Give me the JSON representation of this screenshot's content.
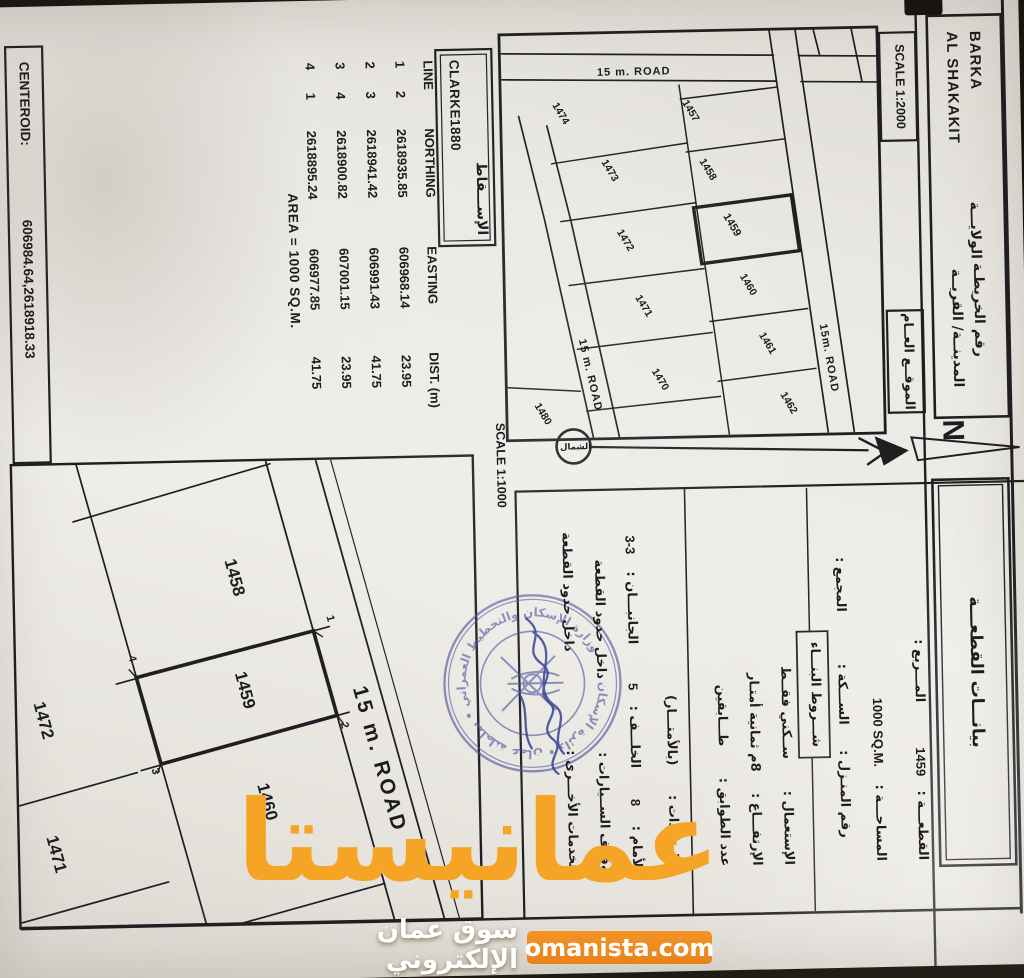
{
  "colors": {
    "ink": "#1d1d20",
    "paper": "#eae8e3",
    "stamp_blue": "#4a4f9b",
    "watermark_orange": "#f6a426",
    "pill_orange": "#ee8c1e"
  },
  "header": {
    "wilaya_label": "الولايـــة",
    "wilaya_value": "BARKA",
    "map_number_label": "رقم الخريطـة",
    "city_label": "المدينــة/ القريــة",
    "city_value": "AL SHAKAKIT",
    "location_map_label": "الموقــع العــام",
    "scale_location": "SCALE 1:2000",
    "plot_data_title": "بيانـــات القطعـــة"
  },
  "north": {
    "letter": "N",
    "circle_label": "الشمال"
  },
  "plot_details": {
    "conditions_box_label": "شـــروط البنـــاء",
    "rows": [
      {
        "y": 106,
        "items": [
          {
            "t": "القطعـــة :",
            "x": 872
          },
          {
            "t": "1459",
            "x": 788,
            "latin": true
          },
          {
            "t": "المـــربع :",
            "x": 714
          }
        ]
      },
      {
        "y": 148,
        "items": [
          {
            "t": "المساحـــة :",
            "x": 872
          },
          {
            "t": "1000 SQ.M.",
            "x": 778,
            "latin": true
          }
        ]
      },
      {
        "y": 183,
        "items": [
          {
            "t": "رقم المنـزل :",
            "x": 848
          },
          {
            "t": "الســـكة :",
            "x": 735
          },
          {
            "t": "المجمع :",
            "x": 622
          }
        ]
      },
      {
        "y": 240,
        "items": [
          {
            "t": "الإستعمال :",
            "x": 874
          },
          {
            "t": "ســكني فقــط",
            "x": 768
          }
        ]
      },
      {
        "y": 272,
        "items": [
          {
            "t": "الإرتفـــاع :",
            "x": 874
          },
          {
            "t": "8م ثمانية أمتـار",
            "x": 780
          }
        ]
      },
      {
        "y": 304,
        "items": [
          {
            "t": "عدد الطوابق :",
            "x": 874
          },
          {
            "t": "طـــابقين",
            "x": 754
          }
        ]
      },
      {
        "y": 355,
        "items": [
          {
            "t": "الإرتدادات :",
            "x": 874
          },
          {
            "t": "(بالأمتـــار)",
            "x": 772
          }
        ]
      },
      {
        "y": 392,
        "items": [
          {
            "t": "الأمام :",
            "x": 878
          },
          {
            "t": "8",
            "x": 812,
            "latin": true
          },
          {
            "t": "الخلـــف :",
            "x": 774
          },
          {
            "t": "5",
            "x": 696,
            "latin": true
          },
          {
            "t": "الجانبـــان :",
            "x": 650
          },
          {
            "t": "3-3",
            "x": 560,
            "latin": true
          }
        ]
      },
      {
        "y": 424,
        "items": [
          {
            "t": "وقوف الســيارات :",
            "x": 878
          },
          {
            "t": "داخل حدود القطعة",
            "x": 684
          }
        ]
      },
      {
        "y": 456,
        "items": [
          {
            "t": "الخدمات الأخـــرى :",
            "x": 878
          },
          {
            "t": "داخل حدود القطعة",
            "x": 656
          }
        ]
      }
    ]
  },
  "projection": {
    "label": "الإســـقاط",
    "value": "CLARKE1880"
  },
  "coords_table": {
    "headers": [
      "LINE",
      "NORTHING",
      "EASTING",
      "DIST. (m)"
    ],
    "rows": [
      [
        "1",
        "2",
        "2618935.85",
        "606968.14",
        "23.95"
      ],
      [
        "2",
        "3",
        "2618941.42",
        "606991.43",
        "41.75"
      ],
      [
        "3",
        "4",
        "2618900.82",
        "607001.15",
        "23.95"
      ],
      [
        "4",
        "1",
        "2618895.24",
        "606977.85",
        "41.75"
      ]
    ],
    "area_line": "AREA = 1000 SQ.M."
  },
  "centeroid": {
    "label": "CENTEROID:",
    "value": "606984.64,2618918.33"
  },
  "scale_site": "SCALE 1:1000",
  "location_map": {
    "plots": [
      {
        "n": "1457",
        "x": 118,
        "y": 330
      },
      {
        "n": "1458",
        "x": 177,
        "y": 314
      },
      {
        "n": "1459",
        "x": 233,
        "y": 291,
        "bold": true
      },
      {
        "n": "1460",
        "x": 293,
        "y": 276
      },
      {
        "n": "1461",
        "x": 352,
        "y": 258
      },
      {
        "n": "1462",
        "x": 412,
        "y": 238
      },
      {
        "n": "1474",
        "x": 118,
        "y": 460
      },
      {
        "n": "1473",
        "x": 176,
        "y": 412
      },
      {
        "n": "1472",
        "x": 246,
        "y": 398
      },
      {
        "n": "1471",
        "x": 312,
        "y": 381
      },
      {
        "n": "1470",
        "x": 386,
        "y": 366
      },
      {
        "n": "1480",
        "x": 418,
        "y": 484
      }
    ],
    "road_labels": [
      {
        "t": "15 m. ROAD",
        "x": 78,
        "y": 386,
        "r": -90
      },
      {
        "t": "15m. ROAD",
        "x": 368,
        "y": 197,
        "r": -9
      },
      {
        "t": "15 m. ROAD",
        "x": 380,
        "y": 436,
        "r": -12
      }
    ]
  },
  "site_plan": {
    "road_label": {
      "t": "15 m. ROAD",
      "x": 760,
      "y": 655,
      "r": -14.5
    },
    "labels": [
      {
        "t": "1458",
        "x": 575,
        "y": 796
      },
      {
        "t": "1459",
        "x": 688,
        "y": 788
      },
      {
        "t": "1460",
        "x": 800,
        "y": 768
      },
      {
        "t": "1472",
        "x": 714,
        "y": 990
      },
      {
        "t": "1471",
        "x": 848,
        "y": 980
      }
    ],
    "corners": [
      {
        "t": "1",
        "x": 618,
        "y": 701
      },
      {
        "t": "2",
        "x": 725,
        "y": 689
      },
      {
        "t": "3",
        "x": 767,
        "y": 879
      },
      {
        "t": "4",
        "x": 654,
        "y": 900
      }
    ]
  },
  "stamp": {
    "ring_text": "وزارة الإسكان والتخطيط العمراني • سلطنة عمان • دائرة الإسكان"
  },
  "watermark": {
    "brand": "عمانيستا",
    "domain": "omanista.com",
    "tagline": "سوق عمان الإلكتروني"
  }
}
